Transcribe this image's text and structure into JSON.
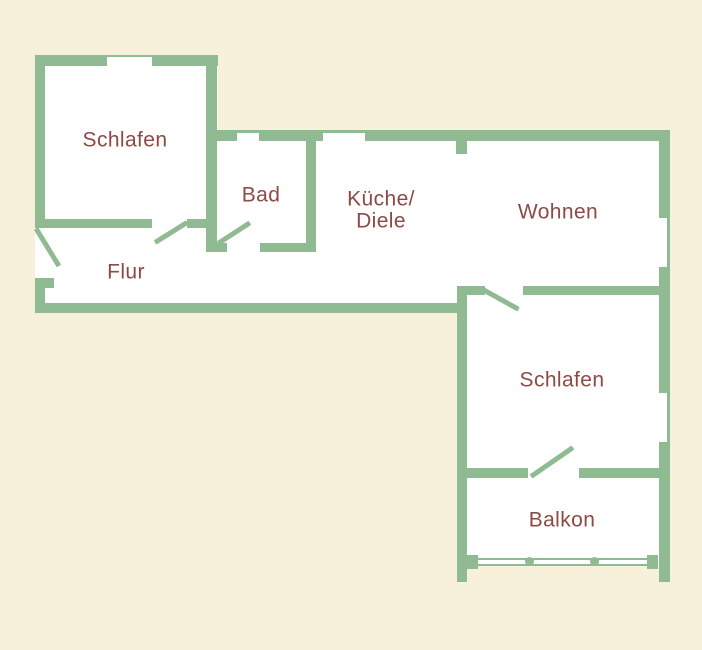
{
  "colors": {
    "background": "#f7f1dc",
    "wall": "#8fba92",
    "floor": "#ffffff",
    "label": "#8d4a45"
  },
  "rooms": {
    "schlafen1": {
      "label": "Schlafen"
    },
    "bad": {
      "label": "Bad"
    },
    "kueche": {
      "line1": "Küche/",
      "line2": "Diele"
    },
    "wohnen": {
      "label": "Wohnen"
    },
    "flur": {
      "label": "Flur"
    },
    "schlafen2": {
      "label": "Schlafen"
    },
    "balkon": {
      "label": "Balkon"
    }
  }
}
